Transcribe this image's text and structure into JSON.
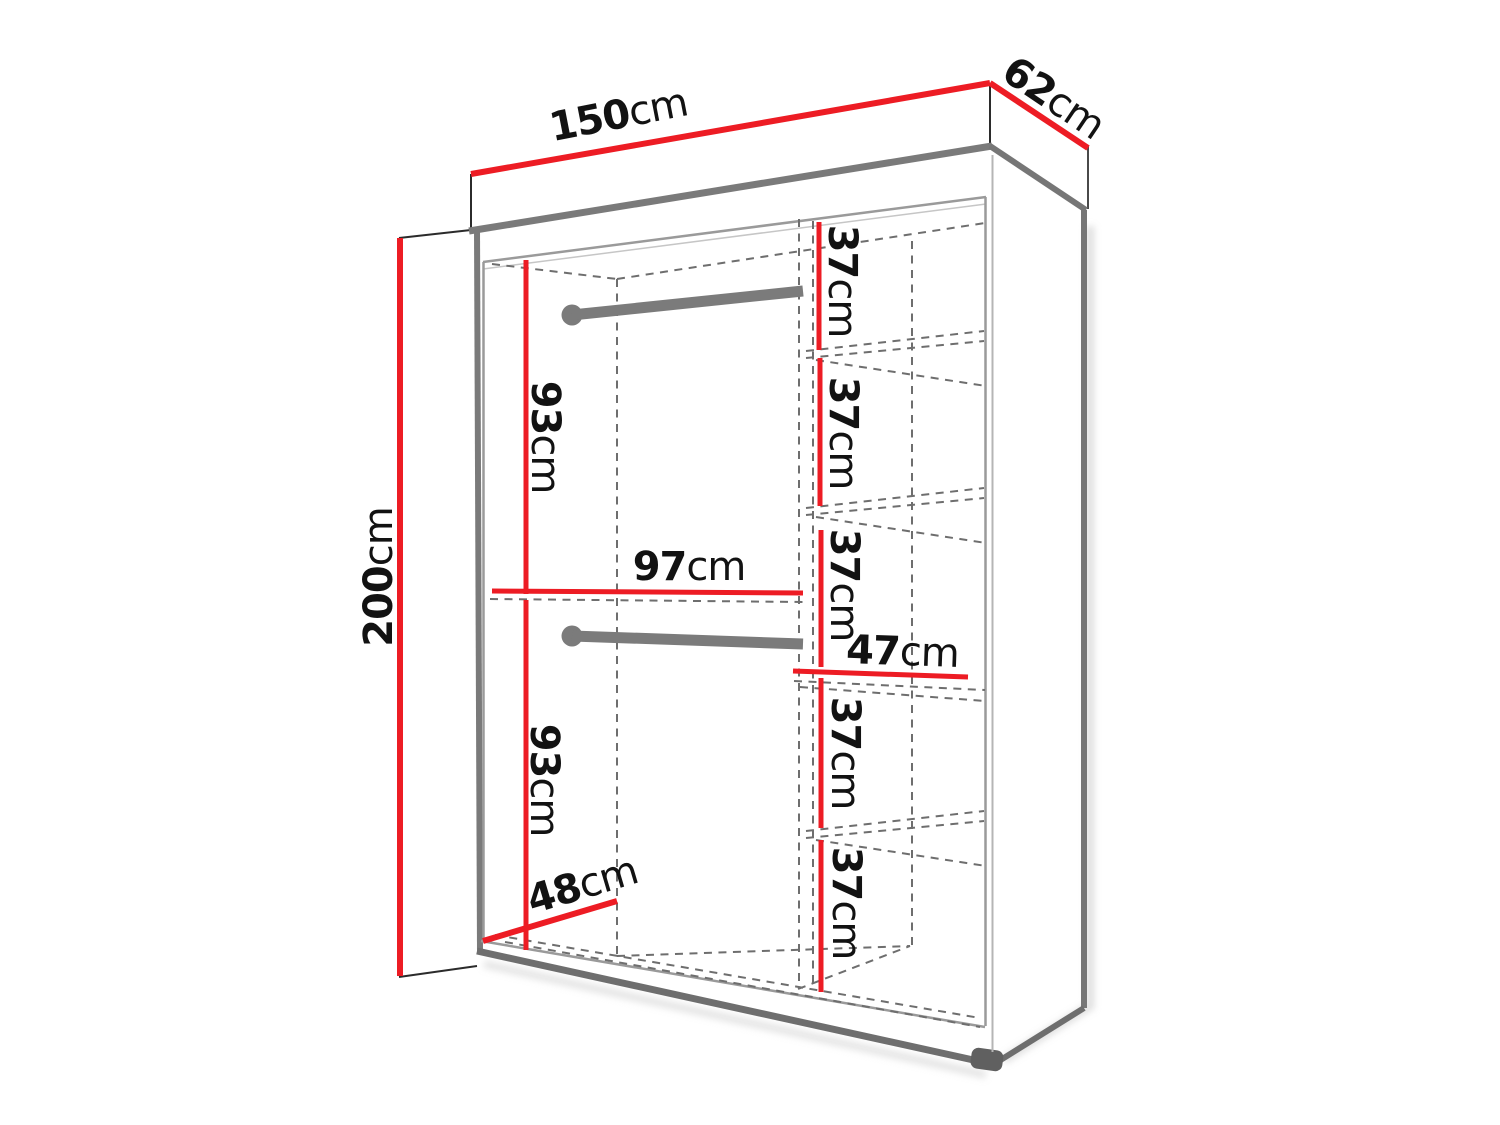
{
  "diagram": {
    "type": "furniture-dimension-diagram",
    "subject": "wardrobe interior dimensions, perspective line drawing",
    "accent_color": "#ed1c24",
    "edge_color": "#7a7a7a",
    "text_color": "#121212",
    "overall": {
      "width": {
        "value": "150",
        "unit": "cm"
      },
      "depth": {
        "value": "62",
        "unit": "cm"
      },
      "height": {
        "value": "200",
        "unit": "cm"
      }
    },
    "interior": {
      "hanging_upper_height": {
        "value": "93",
        "unit": "cm"
      },
      "hanging_lower_height": {
        "value": "93",
        "unit": "cm"
      },
      "hanging_width": {
        "value": "97",
        "unit": "cm"
      },
      "interior_depth": {
        "value": "48",
        "unit": "cm"
      },
      "shelf_width": {
        "value": "47",
        "unit": "cm"
      },
      "shelf_spacings": [
        {
          "value": "37",
          "unit": "cm"
        },
        {
          "value": "37",
          "unit": "cm"
        },
        {
          "value": "37",
          "unit": "cm"
        },
        {
          "value": "37",
          "unit": "cm"
        },
        {
          "value": "37",
          "unit": "cm"
        }
      ]
    }
  }
}
